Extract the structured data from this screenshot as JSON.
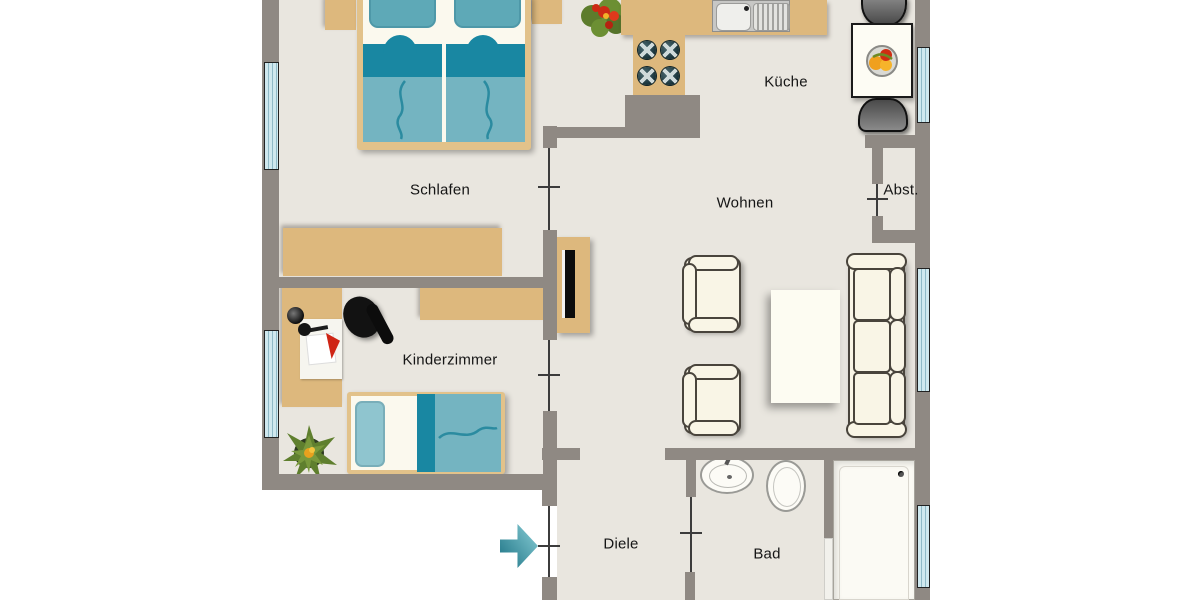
{
  "floorplan": {
    "type": "apartment-floor-plan",
    "rooms": [
      {
        "name": "schlafen",
        "label": "Schlafen"
      },
      {
        "name": "kueche",
        "label": "Küche"
      },
      {
        "name": "wohnen",
        "label": "Wohnen"
      },
      {
        "name": "abstellraum",
        "label": "Abst."
      },
      {
        "name": "kinderzimmer",
        "label": "Kinderzimmer"
      },
      {
        "name": "diele",
        "label": "Diele"
      },
      {
        "name": "bad",
        "label": "Bad"
      }
    ],
    "symbols": [
      "double-bed",
      "nightstand",
      "wardrobe",
      "potted-plant",
      "kitchen-counter",
      "kitchen-sink",
      "stove-burners",
      "dining-table",
      "fruit-bowl",
      "dining-chair",
      "tv-sideboard",
      "tv",
      "armchair",
      "coffee-table",
      "sofa",
      "desk",
      "desk-lamp",
      "office-chair",
      "wall-shelf",
      "single-bed",
      "washbasin",
      "toilet",
      "bathtub",
      "shower-partition",
      "window",
      "door-opening",
      "entrance-arrow"
    ],
    "colors": {
      "wall": "#8f8983",
      "floor": "#e9e6df",
      "outside": "#ffffff",
      "wood": "#ddb87d",
      "teal": "#74b4c1",
      "teal-dark": "#1987a2",
      "pillow": "#5ea9b7",
      "glass": "#cfe8ee",
      "cream": "#f9f5e6",
      "arrow": "#2f9aaa"
    }
  }
}
